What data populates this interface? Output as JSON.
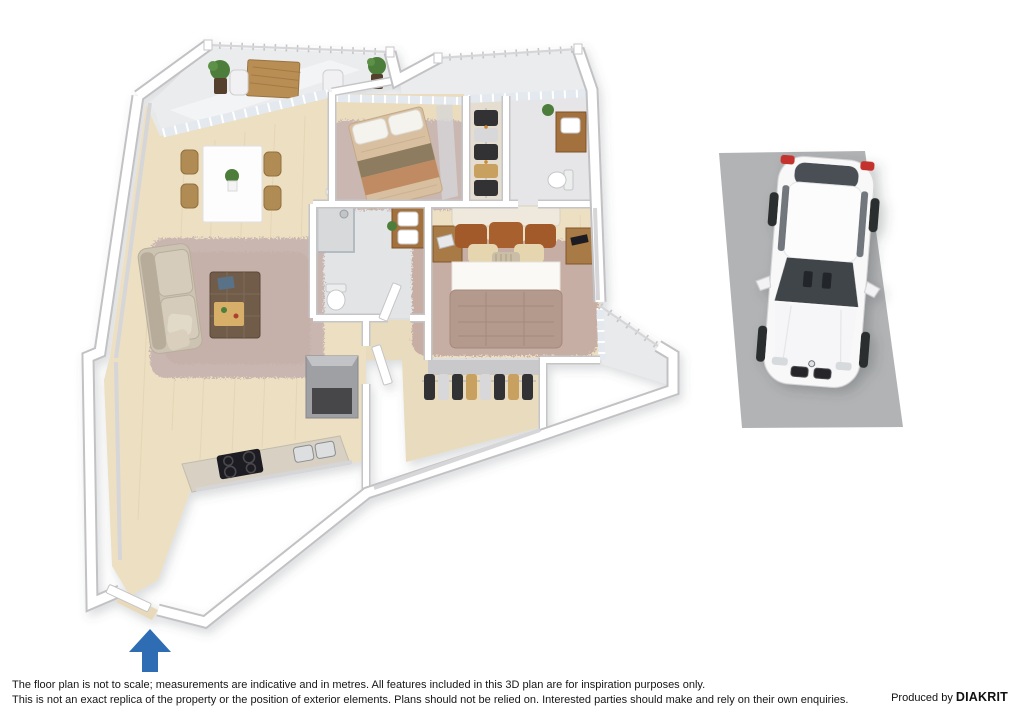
{
  "window": {
    "width": 1024,
    "height": 724,
    "background": "#ffffff"
  },
  "disclaimer": {
    "line1": "The floor plan is not to scale; measurements are indicative and in metres. All features included in this 3D plan are for inspiration purposes only.",
    "line2": "This is not an exact replica of the property or the position of exterior elements. Plans should not be relied on. Interested parties should make and rely on their own enquiries."
  },
  "producer": {
    "prefix": "Produced by ",
    "brand": "DIAKRIT"
  },
  "entrance_arrow": {
    "direction": "up",
    "color": "#2e6cb4"
  },
  "palette": {
    "wood_floor": "#ecdfc2",
    "wall_white": "#ffffff",
    "wall_edge": "#c5c5c8",
    "tile_gray": "#e4e5e7",
    "balcony_gray": "#eaecee",
    "rug_mauve": "#c9b6b0",
    "sofa_beige": "#cdc3b2",
    "furniture_wood": "#b08b52",
    "master_duvet": "#b49a8c",
    "pillow_rust": "#a35a2a",
    "parking_gray": "#b2b3b5",
    "car_white": "#f8f8f9",
    "arrow_blue": "#2e6cb4"
  },
  "scene": {
    "type": "3d-floor-plan-with-car-space",
    "rooms": [
      "balcony",
      "living-dining",
      "kitchen",
      "entrance-hall",
      "bedroom",
      "master-bedroom",
      "bathroom",
      "ensuite-bathroom",
      "walk-in-wardrobe",
      "small-balcony",
      "car-space"
    ]
  }
}
